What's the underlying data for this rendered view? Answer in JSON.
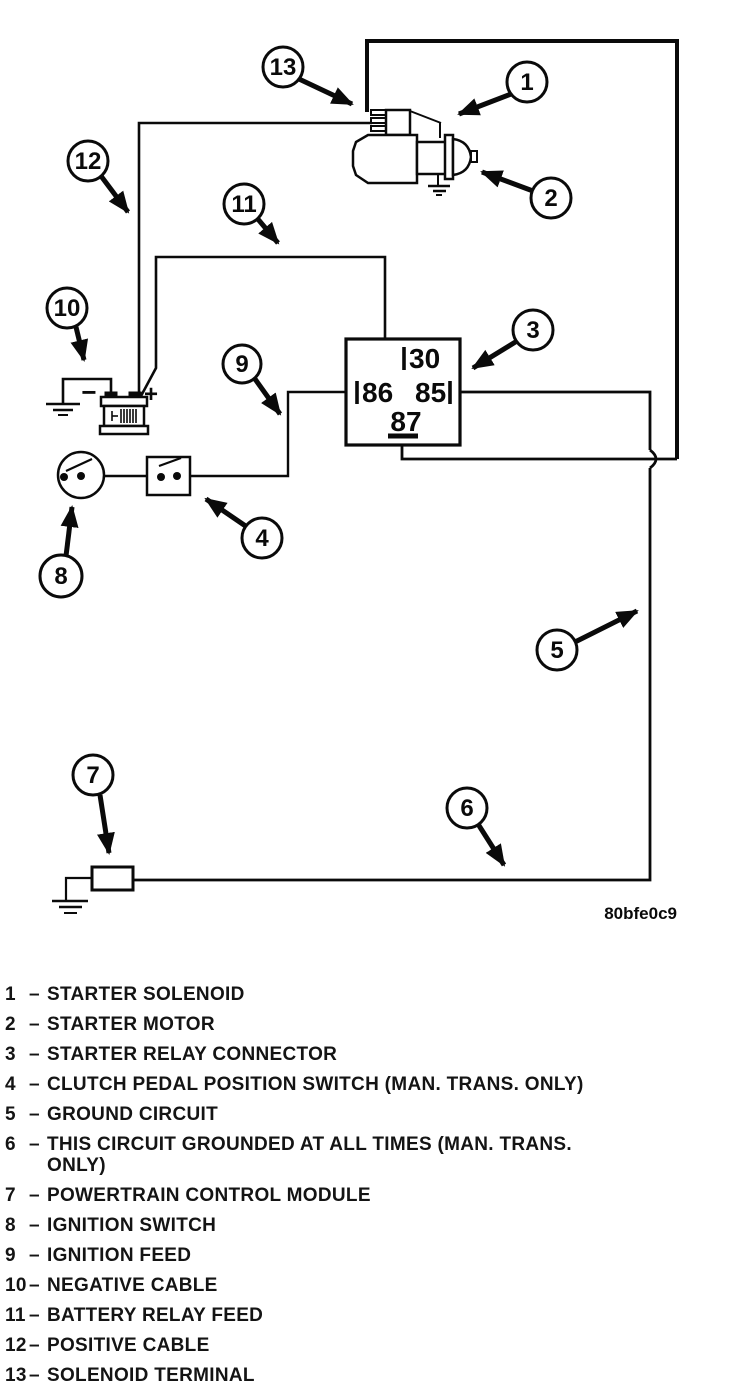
{
  "figure": {
    "code": "80bfe0c9"
  },
  "diagram": {
    "relay": {
      "pin_top": "30",
      "pin_left": "86",
      "pin_right": "85",
      "pin_bottom": "87"
    },
    "battery": {
      "negative": "−",
      "positive": "+"
    },
    "callouts": {
      "c1": "1",
      "c2": "2",
      "c3": "3",
      "c4": "4",
      "c5": "5",
      "c6": "6",
      "c7": "7",
      "c8": "8",
      "c9": "9",
      "c10": "10",
      "c11": "11",
      "c12": "12",
      "c13": "13"
    }
  },
  "legend": {
    "dash": "–",
    "items": [
      {
        "num": "1",
        "text": "STARTER SOLENOID"
      },
      {
        "num": "2",
        "text": "STARTER MOTOR"
      },
      {
        "num": "3",
        "text": "STARTER RELAY CONNECTOR"
      },
      {
        "num": "4",
        "text": "CLUTCH PEDAL POSITION SWITCH (MAN. TRANS. ONLY)"
      },
      {
        "num": "5",
        "text": "GROUND CIRCUIT"
      },
      {
        "num": "6",
        "text": "THIS CIRCUIT GROUNDED AT ALL TIMES (MAN. TRANS.",
        "text2": "ONLY)"
      },
      {
        "num": "7",
        "text": "POWERTRAIN CONTROL MODULE"
      },
      {
        "num": "8",
        "text": "IGNITION SWITCH"
      },
      {
        "num": "9",
        "text": "IGNITION FEED"
      },
      {
        "num": "10",
        "text": "NEGATIVE CABLE"
      },
      {
        "num": "11",
        "text": "BATTERY RELAY FEED"
      },
      {
        "num": "12",
        "text": "POSITIVE CABLE"
      },
      {
        "num": "13",
        "text": "SOLENOID TERMINAL"
      }
    ]
  }
}
